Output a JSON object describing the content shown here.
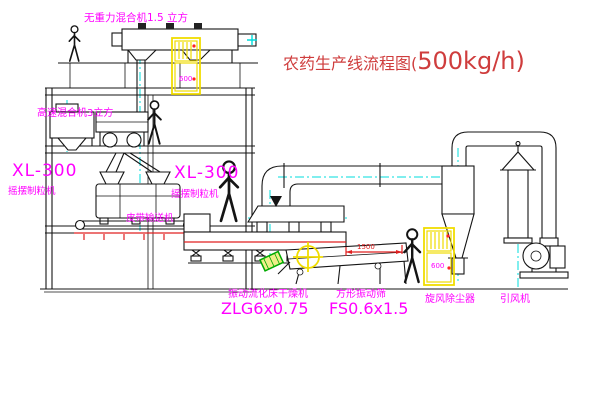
{
  "title": {
    "prefix": "农药生产线流程图(",
    "capacity": "500kg/h)"
  },
  "labels": {
    "top_mixer": "无重力混合机1.5 立方",
    "mixer2": "高速混合机3立方",
    "granulator_model_left": "XL-300",
    "granulator_name_left": "摇摆制粒机",
    "granulator_model_right": "XL-300",
    "granulator_name_right": "摇摆制粒机",
    "belt_conveyor": "皮带输送机",
    "dryer_name": "振动流化床干燥机",
    "dryer_model": "ZLG6x0.75",
    "sieve_name": "方形振动筛",
    "sieve_model": "FS0.6x1.5",
    "cyclone": "旋风除尘器",
    "fan": "引风机",
    "dimension_1500": "1500",
    "cabinet_top_text": "600",
    "cabinet_bottom_text": "600"
  },
  "colors": {
    "label_magenta": "#ff00ff",
    "title_red": "#cf3d3d",
    "centerline_cyan": "#00dcdc",
    "cabinet_yellow": "#f0dc00",
    "dimension_red": "#e02020",
    "line_black": "#141414",
    "background": "#ffffff"
  }
}
